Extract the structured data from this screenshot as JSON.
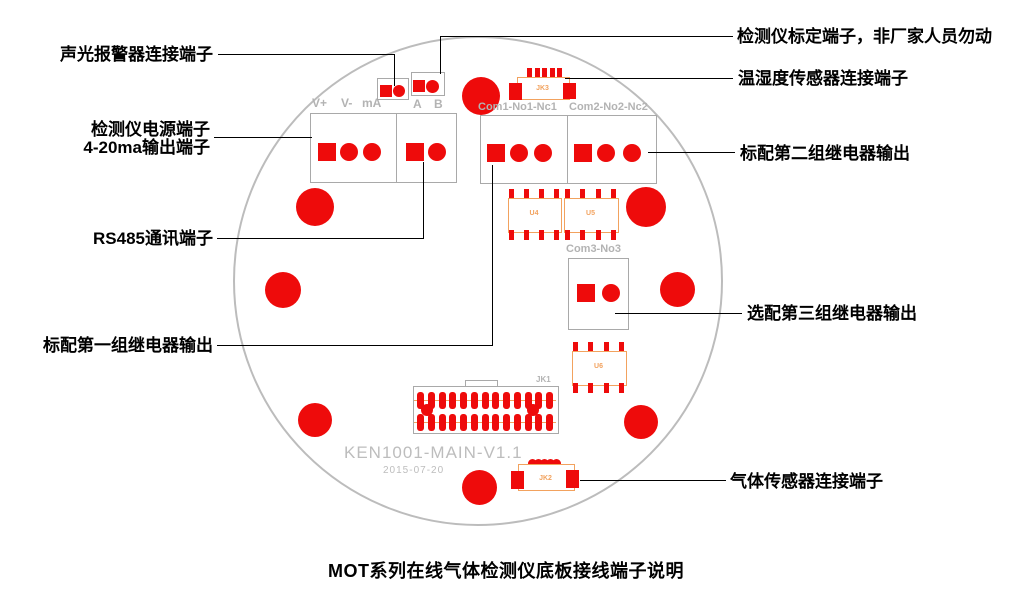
{
  "diagram": {
    "title": "MOT系列在线气体检测仪底板接线端子说明",
    "board_name": "KEN1001-MAIN-V1.1",
    "board_date": "2015-07-20"
  },
  "callouts": {
    "alarm": "声光报警器连接端子",
    "power_line1": "检测仪电源端子",
    "power_line2": "4-20ma输出端子",
    "rs485": "RS485通讯端子",
    "relay1": "标配第一组继电器输出",
    "calibration": "检测仪标定端子，非厂家人员勿动",
    "temp_humidity": "温湿度传感器连接端子",
    "relay2": "标配第二组继电器输出",
    "relay3": "选配第三组继电器输出",
    "gas": "气体传感器连接端子"
  },
  "silkscreen": {
    "power_labels": [
      "V+",
      "V-",
      "mA"
    ],
    "rs485_labels": [
      "A",
      "B"
    ],
    "relay1_label": "Com1-No1-Nc1",
    "relay2_label": "Com2-No2-Nc2",
    "relay3_label": "Com3-No3",
    "jk1": "JK1",
    "jk2": "JK2",
    "jk3": "JK3",
    "u4": "U4",
    "u5": "U5",
    "u6": "U6"
  },
  "colors": {
    "red": "#ee0b0b",
    "orange": "#f2a25e",
    "outline": "#bcbcbc",
    "silk": "#b3b3b3",
    "line": "#000000"
  }
}
